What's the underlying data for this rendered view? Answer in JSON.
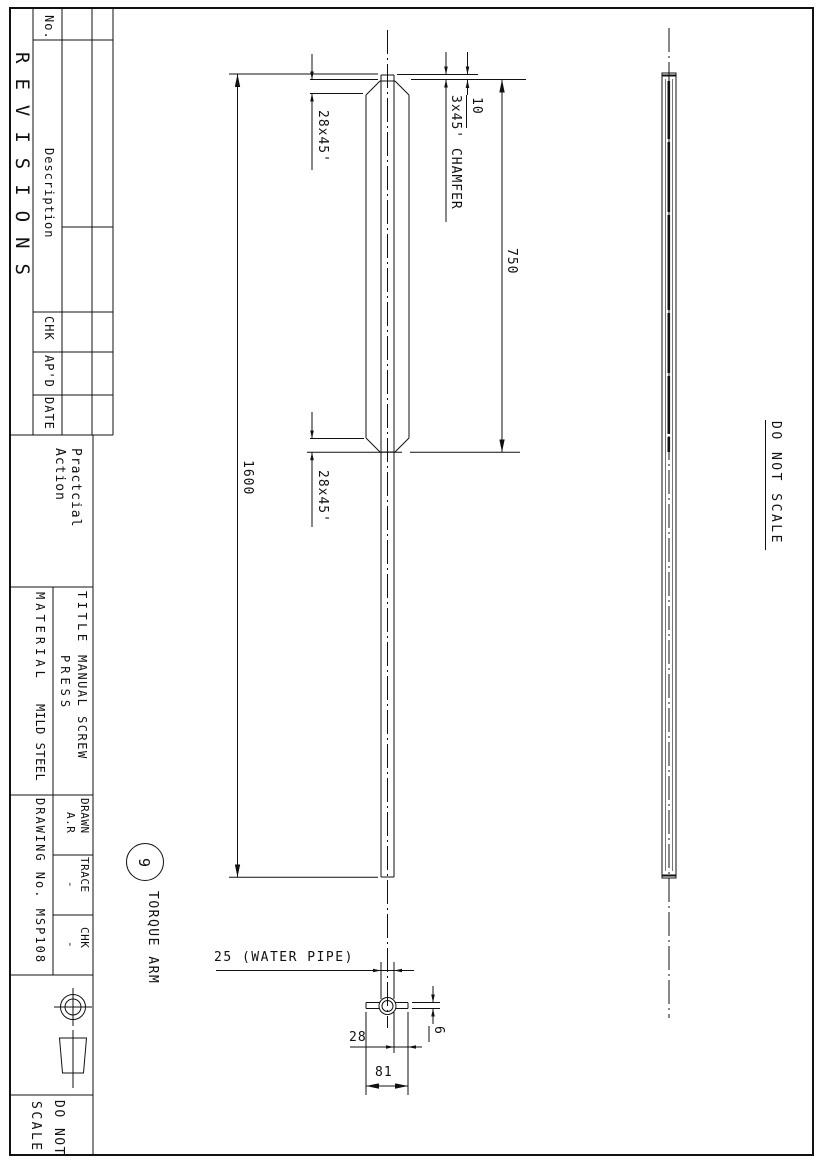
{
  "revisions": {
    "title": "REVISIONS",
    "cols": {
      "no": "No.",
      "description": "Description",
      "chk": "CHK",
      "apd": "AP'D",
      "date": "DATE"
    }
  },
  "company": {
    "line1": "Practcial",
    "line2": "Action"
  },
  "title_block": {
    "title_label": "TITLE",
    "title_line1": "MANUAL SCREW",
    "title_line2": "PRESS",
    "material_label": "MATERIAL",
    "material_value": "MILD STEEL",
    "drawn_label": "DRAWN",
    "drawn_value": "A.R",
    "trace_label": "TRACE",
    "trace_value": "-",
    "chk_label": "CHK",
    "chk_value": "-",
    "drawing_no": "DRAWING No. MSP108",
    "scale_box_line1": "DO NOT",
    "scale_box_line2": "SCALE"
  },
  "notes": {
    "do_not_scale": "DO NOT SCALE",
    "end_chamfer": "3x45' CHAMFER"
  },
  "balloon": {
    "number": "9",
    "label": "TORQUE ARM"
  },
  "dimensions": {
    "overall_length": "1600",
    "flat_length": "750",
    "end_offset": "10",
    "chamfer_left": "28x45'",
    "chamfer_right": "28x45'",
    "pipe_size": "25 (WATER PIPE)",
    "bar_width": "28",
    "overall_width": "81",
    "bar_thickness": "6"
  },
  "colors": {
    "ink": "#111111",
    "paper": "#ffffff"
  }
}
